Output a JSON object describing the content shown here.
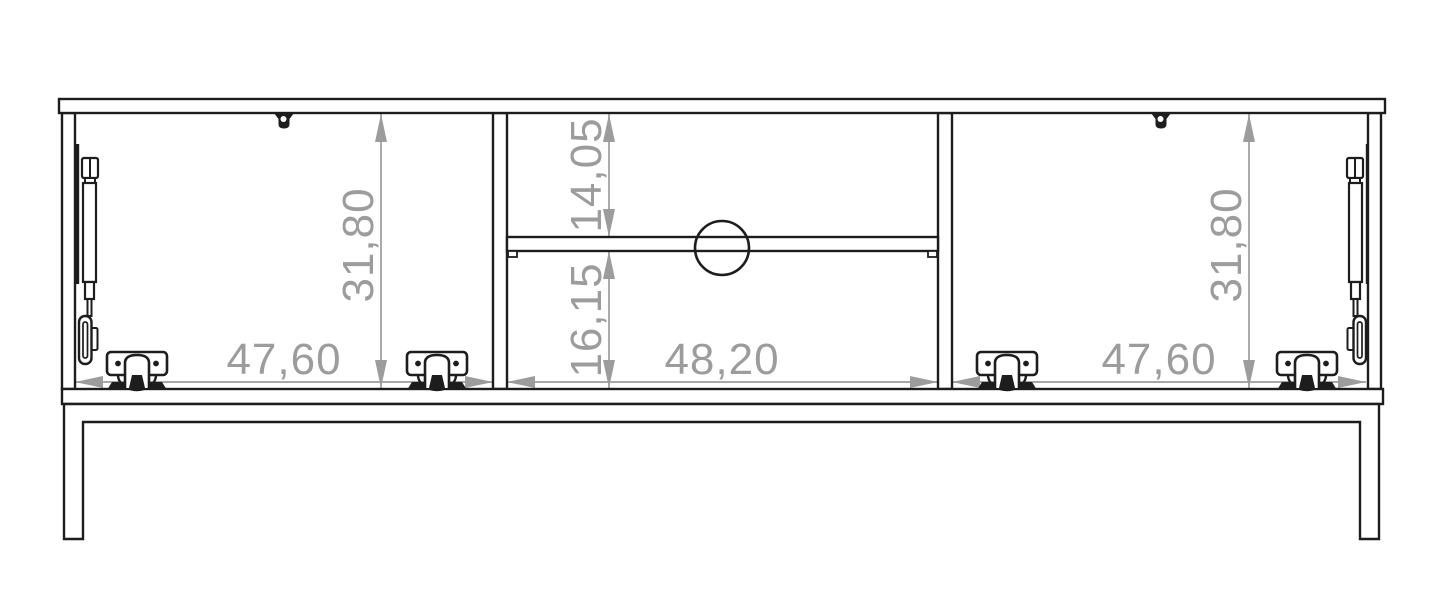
{
  "document": {
    "type": "furniture-technical-drawing-front-view",
    "background_color": "#ffffff",
    "line_color": "#1d1d1d",
    "dimension_color": "#9c9c9c",
    "dimensions": {
      "left_compartment_width": "47,60",
      "middle_compartment_width": "48,20",
      "right_compartment_width": "47,60",
      "left_compartment_height": "31,80",
      "right_compartment_height": "31,80",
      "middle_upper_niche_height": "14,05",
      "middle_lower_niche_height": "16,15"
    },
    "components": {
      "hinge_count": 4,
      "gas_strut_count": 2,
      "cable_hole": "circle",
      "legs": 2
    }
  }
}
